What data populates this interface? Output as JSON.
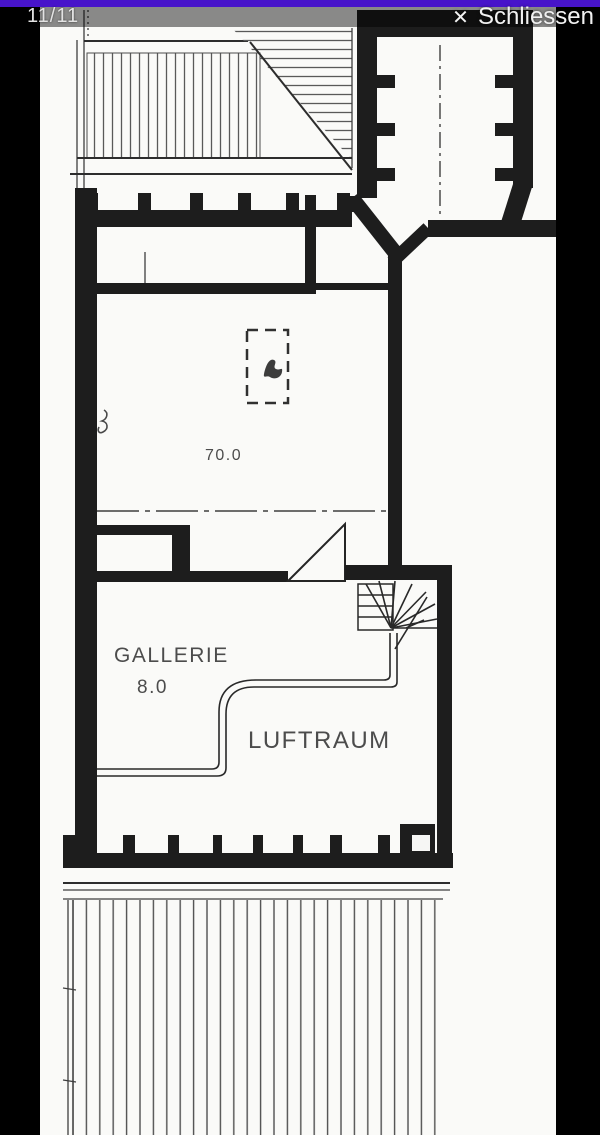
{
  "viewer": {
    "counter": "11/11",
    "close": {
      "icon": "✕",
      "label": "Schliessen"
    },
    "colors": {
      "accent": "#4714ca",
      "background": "#000000",
      "overlay": "rgba(0,0,0,0.45)",
      "paper": "#fafaf8"
    }
  },
  "floorplan": {
    "labels": {
      "main_area_value": "70.0",
      "gallery_label": "GALLERIE",
      "gallery_area_value": "8.0",
      "void_label": "LUFTRAUM"
    }
  }
}
